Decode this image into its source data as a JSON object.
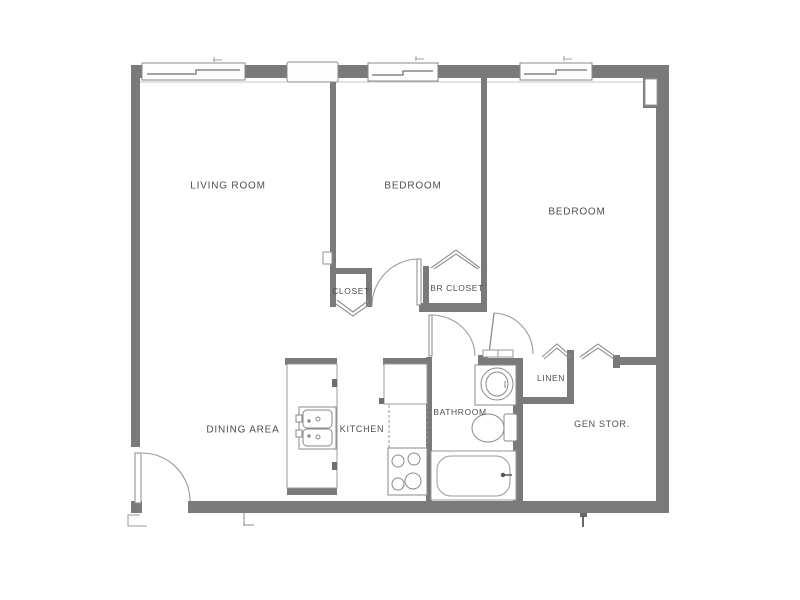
{
  "figure": {
    "type": "apartment-floor-plan",
    "window_count": 4
  },
  "colors": {
    "wall": "#7a7a7a",
    "wall_dark": "#6e6e6e",
    "fixture_line": "#8a8a8a",
    "door_line": "#9a9a9a",
    "label_text": "#4e4e4e",
    "background": "#ffffff"
  },
  "rooms": [
    {
      "id": "living-room",
      "label": "LIVING ROOM"
    },
    {
      "id": "dining-area",
      "label": "DINING AREA"
    },
    {
      "id": "kitchen",
      "label": "KITCHEN"
    },
    {
      "id": "bedroom-1",
      "label": "BEDROOM"
    },
    {
      "id": "bedroom-2",
      "label": "BEDROOM"
    },
    {
      "id": "closet",
      "label": "CLOSET"
    },
    {
      "id": "br-closet",
      "label": "BR CLOSET"
    },
    {
      "id": "bathroom",
      "label": "BATHROOM"
    },
    {
      "id": "linen",
      "label": "LINEN"
    },
    {
      "id": "gen-stor",
      "label": "GEN STOR."
    }
  ],
  "fixtures": [
    "kitchen-double-sink-icon",
    "refrigerator-icon",
    "upper-cabinet-dashed-icon",
    "range-burners-icon",
    "vanity-sink-icon",
    "toilet-icon",
    "bathtub-icon"
  ],
  "doors": [
    "entry-door-swing",
    "bedroom-1-door-swing",
    "bedroom-2-door-swing",
    "bathroom-door-swing",
    "closet-bifold-door",
    "br-closet-bifold-door",
    "linen-bifold-door",
    "gen-stor-bifold-door"
  ]
}
